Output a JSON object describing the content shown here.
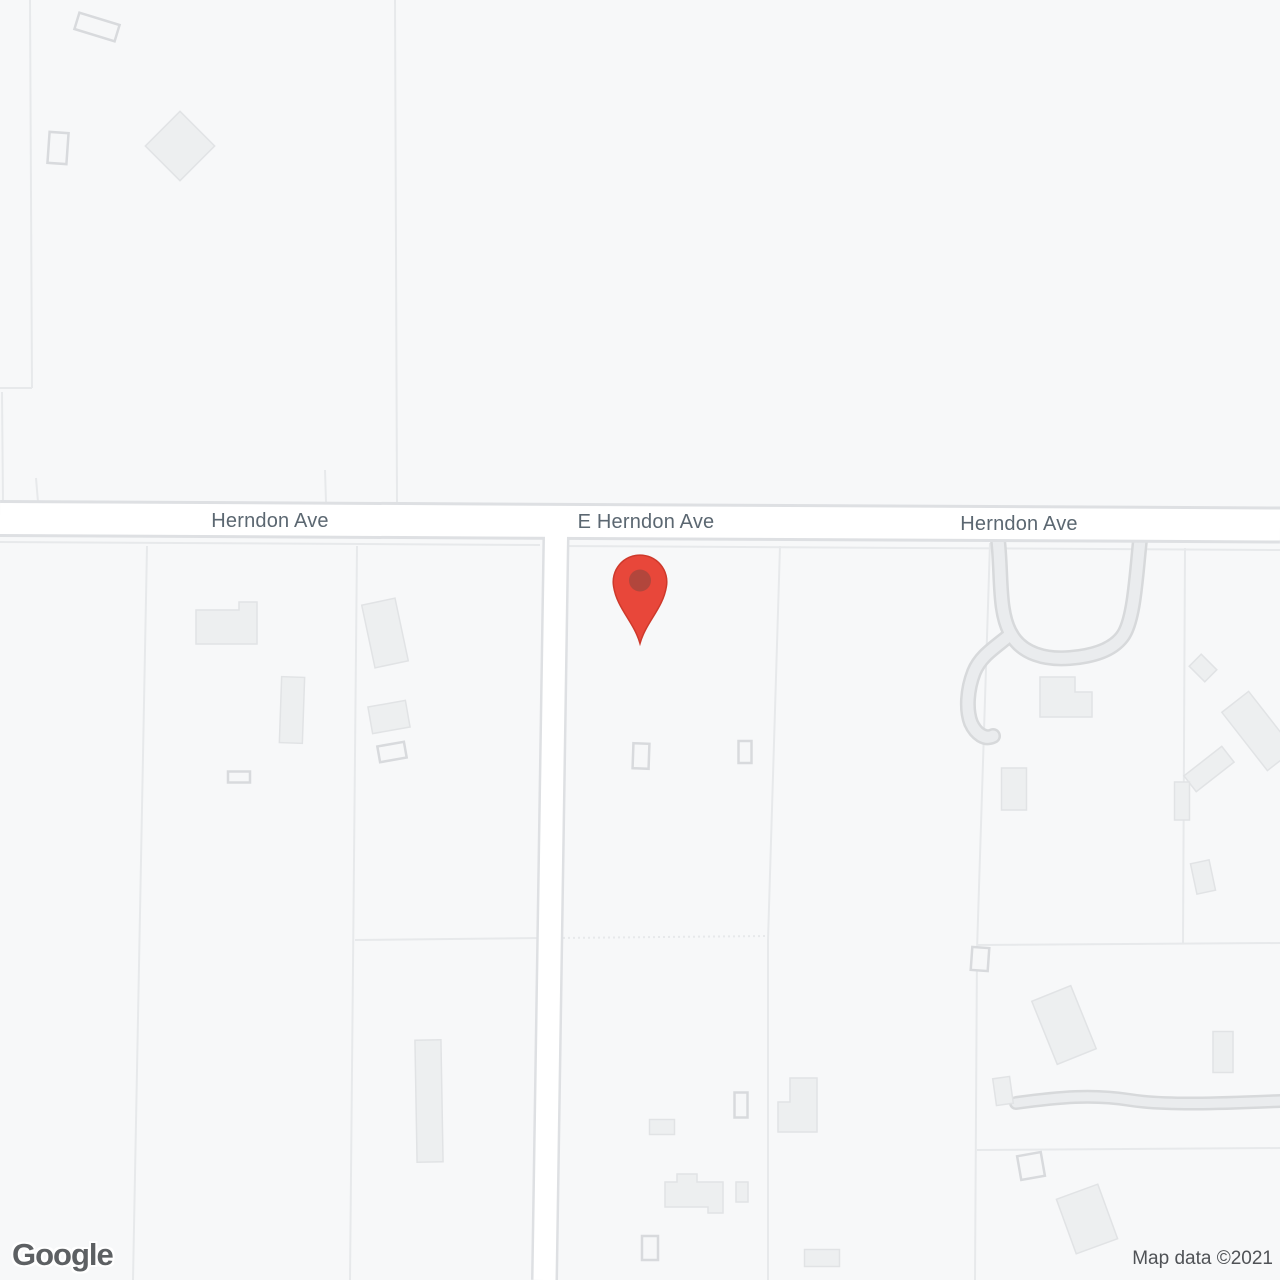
{
  "attribution": {
    "logo_text": "Google",
    "text": "Map data ©2021"
  },
  "map": {
    "colors": {
      "background": "#f7f8f9",
      "parcel_line": "#e7e9eb",
      "road_fill": "#ffffff",
      "road_casing": "#dee0e3",
      "minor_fill": "#eaecee",
      "minor_casing": "#d7d9db",
      "building_fill": "#edeff0",
      "building_stroke": "#e1e3e5",
      "hollow_fill": "#f6f7f8",
      "hollow_stroke": "#d8dadd",
      "label": "#5b6771"
    },
    "road_labels": [
      {
        "text": "Herndon Ave",
        "x": 270,
        "y": 527
      },
      {
        "text": "E Herndon Ave",
        "x": 646,
        "y": 528
      },
      {
        "text": "Herndon Ave",
        "x": 1019,
        "y": 530
      }
    ],
    "pin": {
      "path": "M640 643.5 C634 622 617 608.5 613.6 586.5 A26.8 26.8 0 1 1 666.4 586.5 C663 608.5 646 622 640 643.5 Z",
      "inner_cx": 640,
      "inner_cy": 580.5,
      "inner_r": 11,
      "body": "#e8473a",
      "inner": "#b2463c",
      "outline": "#ce392b"
    },
    "parcel_lines": [
      {
        "pts": "30,0 32,388"
      },
      {
        "pts": "0,388 32,388"
      },
      {
        "pts": "36,478 38,502"
      },
      {
        "pts": "2,392 3,502"
      },
      {
        "pts": "325,470 326,502"
      },
      {
        "pts": "395,0 397,502"
      },
      {
        "pts": "0,542 540,545"
      },
      {
        "pts": "558,546 1280,550"
      },
      {
        "pts": "147,546 133,1280"
      },
      {
        "pts": "357,546 350,1280"
      },
      {
        "pts": "780,546 768,940 768,1280"
      },
      {
        "pts": "990,543 977,950 975,1280"
      },
      {
        "pts": "1185,548 1183,944"
      },
      {
        "pts": "355,940 540,938"
      },
      {
        "pts": "558,938 768,936",
        "dash": "2 3"
      },
      {
        "pts": "977,945 1280,943"
      },
      {
        "pts": "977,1150 1280,1148"
      }
    ],
    "minor_roads": [
      {
        "d": "M998 540 C1002 575 998 612 1011 634 C1022 654 1046 660 1070 658 C1094 656 1112 650 1122 637 C1134 622 1136 578 1140 540",
        "cap": "butt",
        "casing_w": 16,
        "fill_w": 11
      },
      {
        "d": "M1011 634 C996 647 981 655 974 672 C967 690 966 710 971 723 C976 734 985 740 993 736",
        "cap": "round",
        "casing_w": 16,
        "fill_w": 11
      },
      {
        "d": "M1016 1103 C1060 1097 1092 1094 1130 1100 C1168 1106 1230 1103 1280 1101",
        "cap": "round",
        "casing_w": 14,
        "fill_w": 9
      }
    ],
    "roads": [
      {
        "d": "M0 518.5 L1280 525",
        "casing_w": 37,
        "fill_w": 31
      },
      {
        "d": "M556 536 L544.5 1280",
        "casing_w": 27,
        "fill_w": 22
      }
    ],
    "buildings": [
      {
        "cx": 97,
        "cy": 27,
        "w": 42,
        "h": 17,
        "rot": 17,
        "style": "hollow"
      },
      {
        "cx": 58,
        "cy": 148,
        "w": 19,
        "h": 31,
        "rot": 4,
        "style": "hollow"
      },
      {
        "cx": 180,
        "cy": 146,
        "w": 49,
        "h": 49,
        "rot": 45,
        "style": "filled"
      },
      {
        "pts": "196,610 239,610 239,602 257,602 257,644 196,644",
        "style": "filled"
      },
      {
        "cx": 292,
        "cy": 710,
        "w": 23,
        "h": 66,
        "rot": 2,
        "style": "filled"
      },
      {
        "cx": 239,
        "cy": 777,
        "w": 22,
        "h": 11,
        "rot": 0,
        "style": "hollow"
      },
      {
        "cx": 385,
        "cy": 633,
        "w": 34,
        "h": 64,
        "rot": -12,
        "style": "filled"
      },
      {
        "cx": 389,
        "cy": 717,
        "w": 38,
        "h": 27,
        "rot": -10,
        "style": "filled"
      },
      {
        "cx": 392,
        "cy": 752,
        "w": 27,
        "h": 16,
        "rot": -10,
        "style": "hollow"
      },
      {
        "cx": 429,
        "cy": 1101,
        "w": 26,
        "h": 122,
        "rot": -1,
        "style": "filled"
      },
      {
        "cx": 662,
        "cy": 1127,
        "w": 25,
        "h": 15,
        "rot": 0,
        "style": "filled"
      },
      {
        "cx": 641,
        "cy": 756,
        "w": 16,
        "h": 25,
        "rot": 2,
        "style": "hollow"
      },
      {
        "cx": 745,
        "cy": 752,
        "w": 13,
        "h": 22,
        "rot": 0,
        "style": "hollow"
      },
      {
        "cx": 741,
        "cy": 1105,
        "w": 13,
        "h": 25,
        "rot": 0,
        "style": "hollow"
      },
      {
        "pts": "665,1182 677,1182 677,1174 697,1174 697,1182 723,1182 723,1213 708,1213 708,1207 665,1207",
        "style": "filled"
      },
      {
        "cx": 742,
        "cy": 1192,
        "w": 12,
        "h": 20,
        "rot": 0,
        "style": "filled"
      },
      {
        "cx": 650,
        "cy": 1248,
        "w": 16,
        "h": 24,
        "rot": 0,
        "style": "hollow"
      },
      {
        "pts": "790,1078 817,1078 817,1132 778,1132 778,1102 790,1102",
        "style": "filled"
      },
      {
        "cx": 822,
        "cy": 1258,
        "w": 35,
        "h": 17,
        "rot": 0,
        "style": "filled"
      },
      {
        "pts": "1040,677 1075,677 1075,692 1092,692 1092,717 1040,717",
        "style": "filled"
      },
      {
        "cx": 1203,
        "cy": 668,
        "w": 22,
        "h": 17,
        "rot": 45,
        "style": "filled"
      },
      {
        "cx": 1258,
        "cy": 731,
        "w": 34,
        "h": 74,
        "rot": -38,
        "style": "filled"
      },
      {
        "cx": 1209,
        "cy": 769,
        "w": 48,
        "h": 20,
        "rot": -38,
        "style": "filled"
      },
      {
        "cx": 1014,
        "cy": 789,
        "w": 25,
        "h": 42,
        "rot": 0,
        "style": "filled"
      },
      {
        "cx": 1182,
        "cy": 801,
        "w": 15,
        "h": 38,
        "rot": 0,
        "style": "filled"
      },
      {
        "cx": 1203,
        "cy": 877,
        "w": 19,
        "h": 31,
        "rot": -12,
        "style": "filled"
      },
      {
        "cx": 980,
        "cy": 959,
        "w": 17,
        "h": 23,
        "rot": 4,
        "style": "hollow"
      },
      {
        "cx": 1064,
        "cy": 1025,
        "w": 42,
        "h": 68,
        "rot": -22,
        "style": "filled"
      },
      {
        "cx": 1003,
        "cy": 1091,
        "w": 17,
        "h": 27,
        "rot": -8,
        "style": "filled"
      },
      {
        "cx": 1223,
        "cy": 1052,
        "w": 20,
        "h": 41,
        "rot": 0,
        "style": "filled"
      },
      {
        "cx": 1031,
        "cy": 1166,
        "w": 24,
        "h": 24,
        "rot": -10,
        "style": "hollow"
      },
      {
        "cx": 1087,
        "cy": 1219,
        "w": 44,
        "h": 58,
        "rot": -20,
        "style": "filled"
      }
    ]
  }
}
